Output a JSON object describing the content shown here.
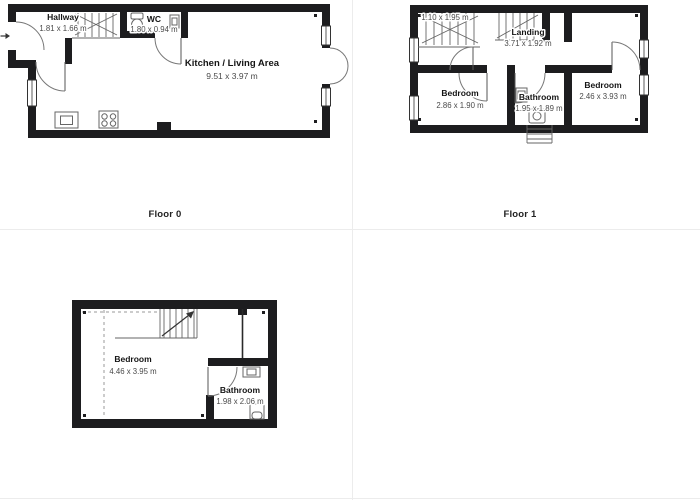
{
  "colors": {
    "wall": "#1d1d1f",
    "divider": "#ececec",
    "room_name": "#141414",
    "room_dims": "#4a4a4a",
    "caption": "#222222"
  },
  "floor0": {
    "caption": "Floor 0",
    "rooms": {
      "hallway": {
        "name": "Hallway",
        "dims": "1.81 x 1.66 m"
      },
      "wc": {
        "name": "WC",
        "dims": "1.80 x 0.94 m"
      },
      "kitchen": {
        "name": "Kitchen / Living Area",
        "dims": "9.51 x 3.97 m"
      }
    }
  },
  "floor1": {
    "caption": "Floor 1",
    "rooms": {
      "stair_space": {
        "dims": "1.10 x 1.95 m"
      },
      "landing": {
        "name": "Landing",
        "dims": "3.71 x 1.92 m"
      },
      "bedroom_left": {
        "name": "Bedroom",
        "dims": "2.86 x 1.90 m"
      },
      "bathroom": {
        "name": "Bathroom",
        "dims": "1.95 x 1.89 m"
      },
      "bedroom_right": {
        "name": "Bedroom",
        "dims": "2.46 x 3.93 m"
      }
    }
  },
  "floor2": {
    "rooms": {
      "bedroom": {
        "name": "Bedroom",
        "dims": "4.46 x 3.95 m"
      },
      "bathroom": {
        "name": "Bathroom",
        "dims": "1.98 x 2.06 m"
      }
    }
  }
}
